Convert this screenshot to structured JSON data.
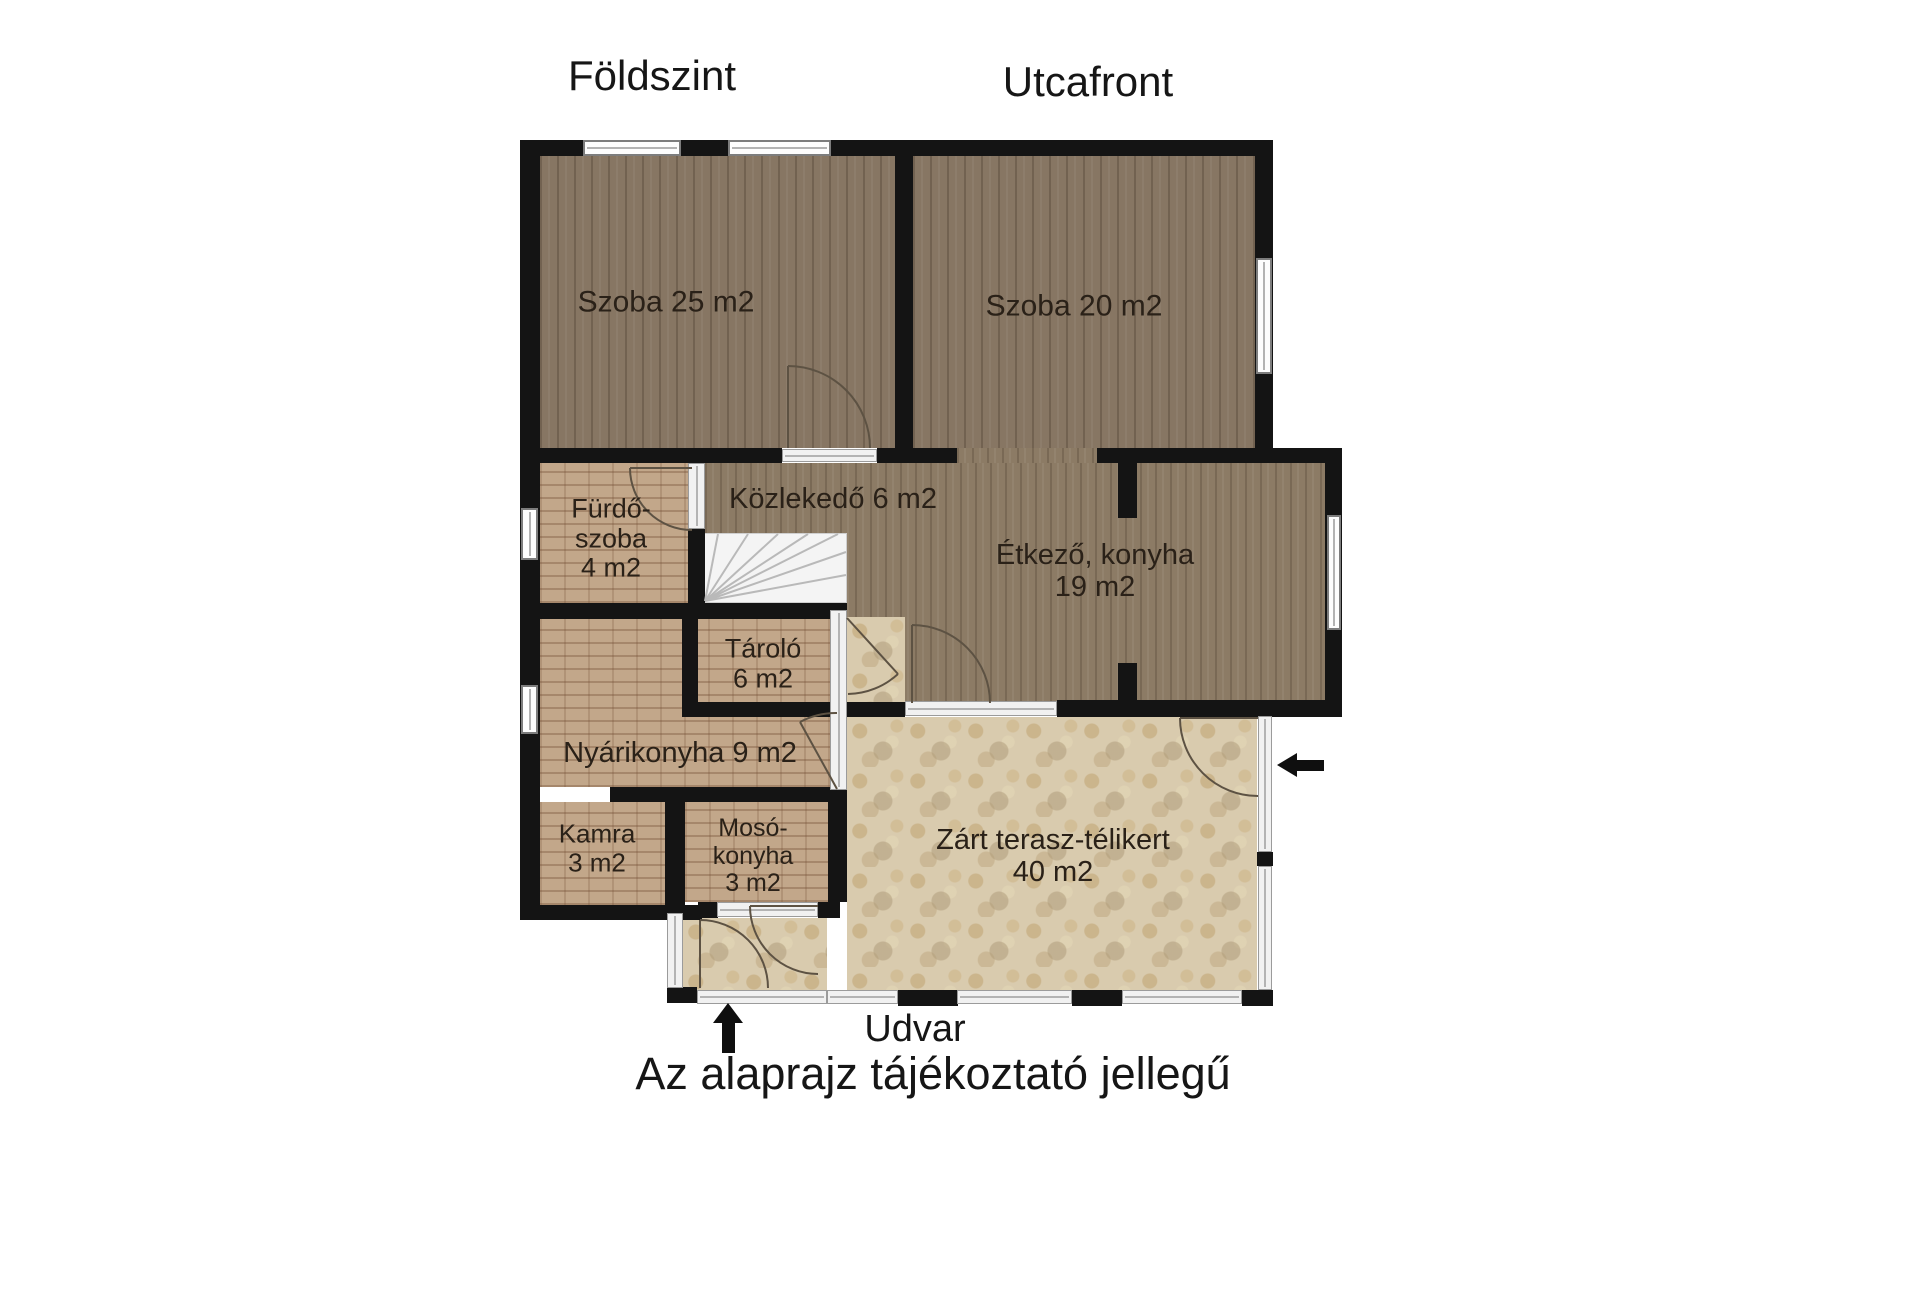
{
  "titles": {
    "left": "Földszint",
    "right": "Utcafront"
  },
  "rooms": {
    "szoba25": {
      "label": "Szoba 25 m2"
    },
    "szoba20": {
      "label": "Szoba 20 m2"
    },
    "kozlekedo": {
      "label": "Közlekedő 6 m2"
    },
    "furdoszoba": {
      "line1": "Fürdő-",
      "line2": "szoba",
      "line3": "4 m2"
    },
    "etkezo": {
      "line1": "Étkező, konyha",
      "line2": "19 m2"
    },
    "tarolo": {
      "line1": "Tároló",
      "line2": "6 m2"
    },
    "nyarikonyha": {
      "label": "Nyárikonyha 9 m2"
    },
    "kamra": {
      "line1": "Kamra",
      "line2": "3 m2"
    },
    "mosokonyha": {
      "line1": "Mosó-",
      "line2": "konyha",
      "line3": "3 m2"
    },
    "terasz": {
      "line1": "Zárt terasz-télikert",
      "line2": "40 m2"
    }
  },
  "footer": {
    "yard_label": "Udvar",
    "disclaimer": "Az alaprajz tájékoztató jellegű"
  },
  "icons": {
    "entrance_arrow_bottom": "up-arrow",
    "entrance_arrow_right": "left-arrow"
  },
  "colors": {
    "wall": "#141414",
    "wood_floor": "#8c7b65",
    "brick_floor": "#c2a78a",
    "stone_floor": "#d9cbae",
    "label_text": "#2a2118",
    "background": "#ffffff"
  }
}
